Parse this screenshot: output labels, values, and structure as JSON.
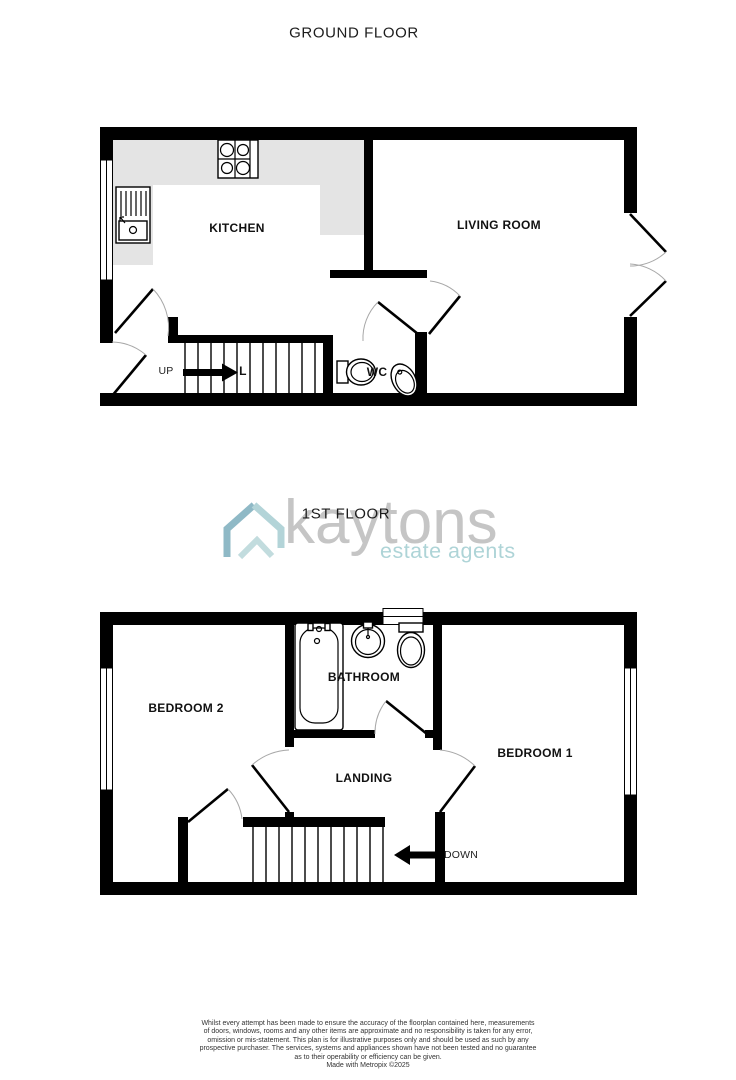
{
  "ground_floor": {
    "title": "GROUND FLOOR",
    "labels": {
      "kitchen": "KITCHEN",
      "living_room": "LIVING ROOM",
      "wc": "WC",
      "up": "UP",
      "hall_partial": "L"
    }
  },
  "first_floor": {
    "title": "1ST FLOOR",
    "labels": {
      "bathroom": "BATHROOM",
      "bedroom_2": "BEDROOM 2",
      "bedroom_1": "BEDROOM 1",
      "landing": "LANDING",
      "down": "DOWN"
    }
  },
  "logo": {
    "name": "kaytons",
    "tagline": "estate agents",
    "icon": "house-icon",
    "colors": {
      "name_text": "#c5c5c5",
      "tagline_text": "#aed4d7",
      "icon_light": "#b3d4d8",
      "icon_dark": "#8fb9c6"
    }
  },
  "footer": {
    "disclaimer_lines": [
      "Whilst every attempt has been made to ensure the accuracy of the floorplan contained here, measurements",
      "of doors, windows, rooms and any other items are approximate and no responsibility is taken for any error,",
      "omission or mis-statement. This plan is for illustrative purposes only and should be used as such by any",
      "prospective purchaser. The services, systems and appliances shown have not been tested and no guarantee",
      "as to their operability or efficiency can be given."
    ],
    "credit": "Made with Metropix ©2025"
  },
  "colors": {
    "wall": "#000000",
    "counter": "#e4e4e4",
    "door_arc": "#a8a8a8"
  }
}
